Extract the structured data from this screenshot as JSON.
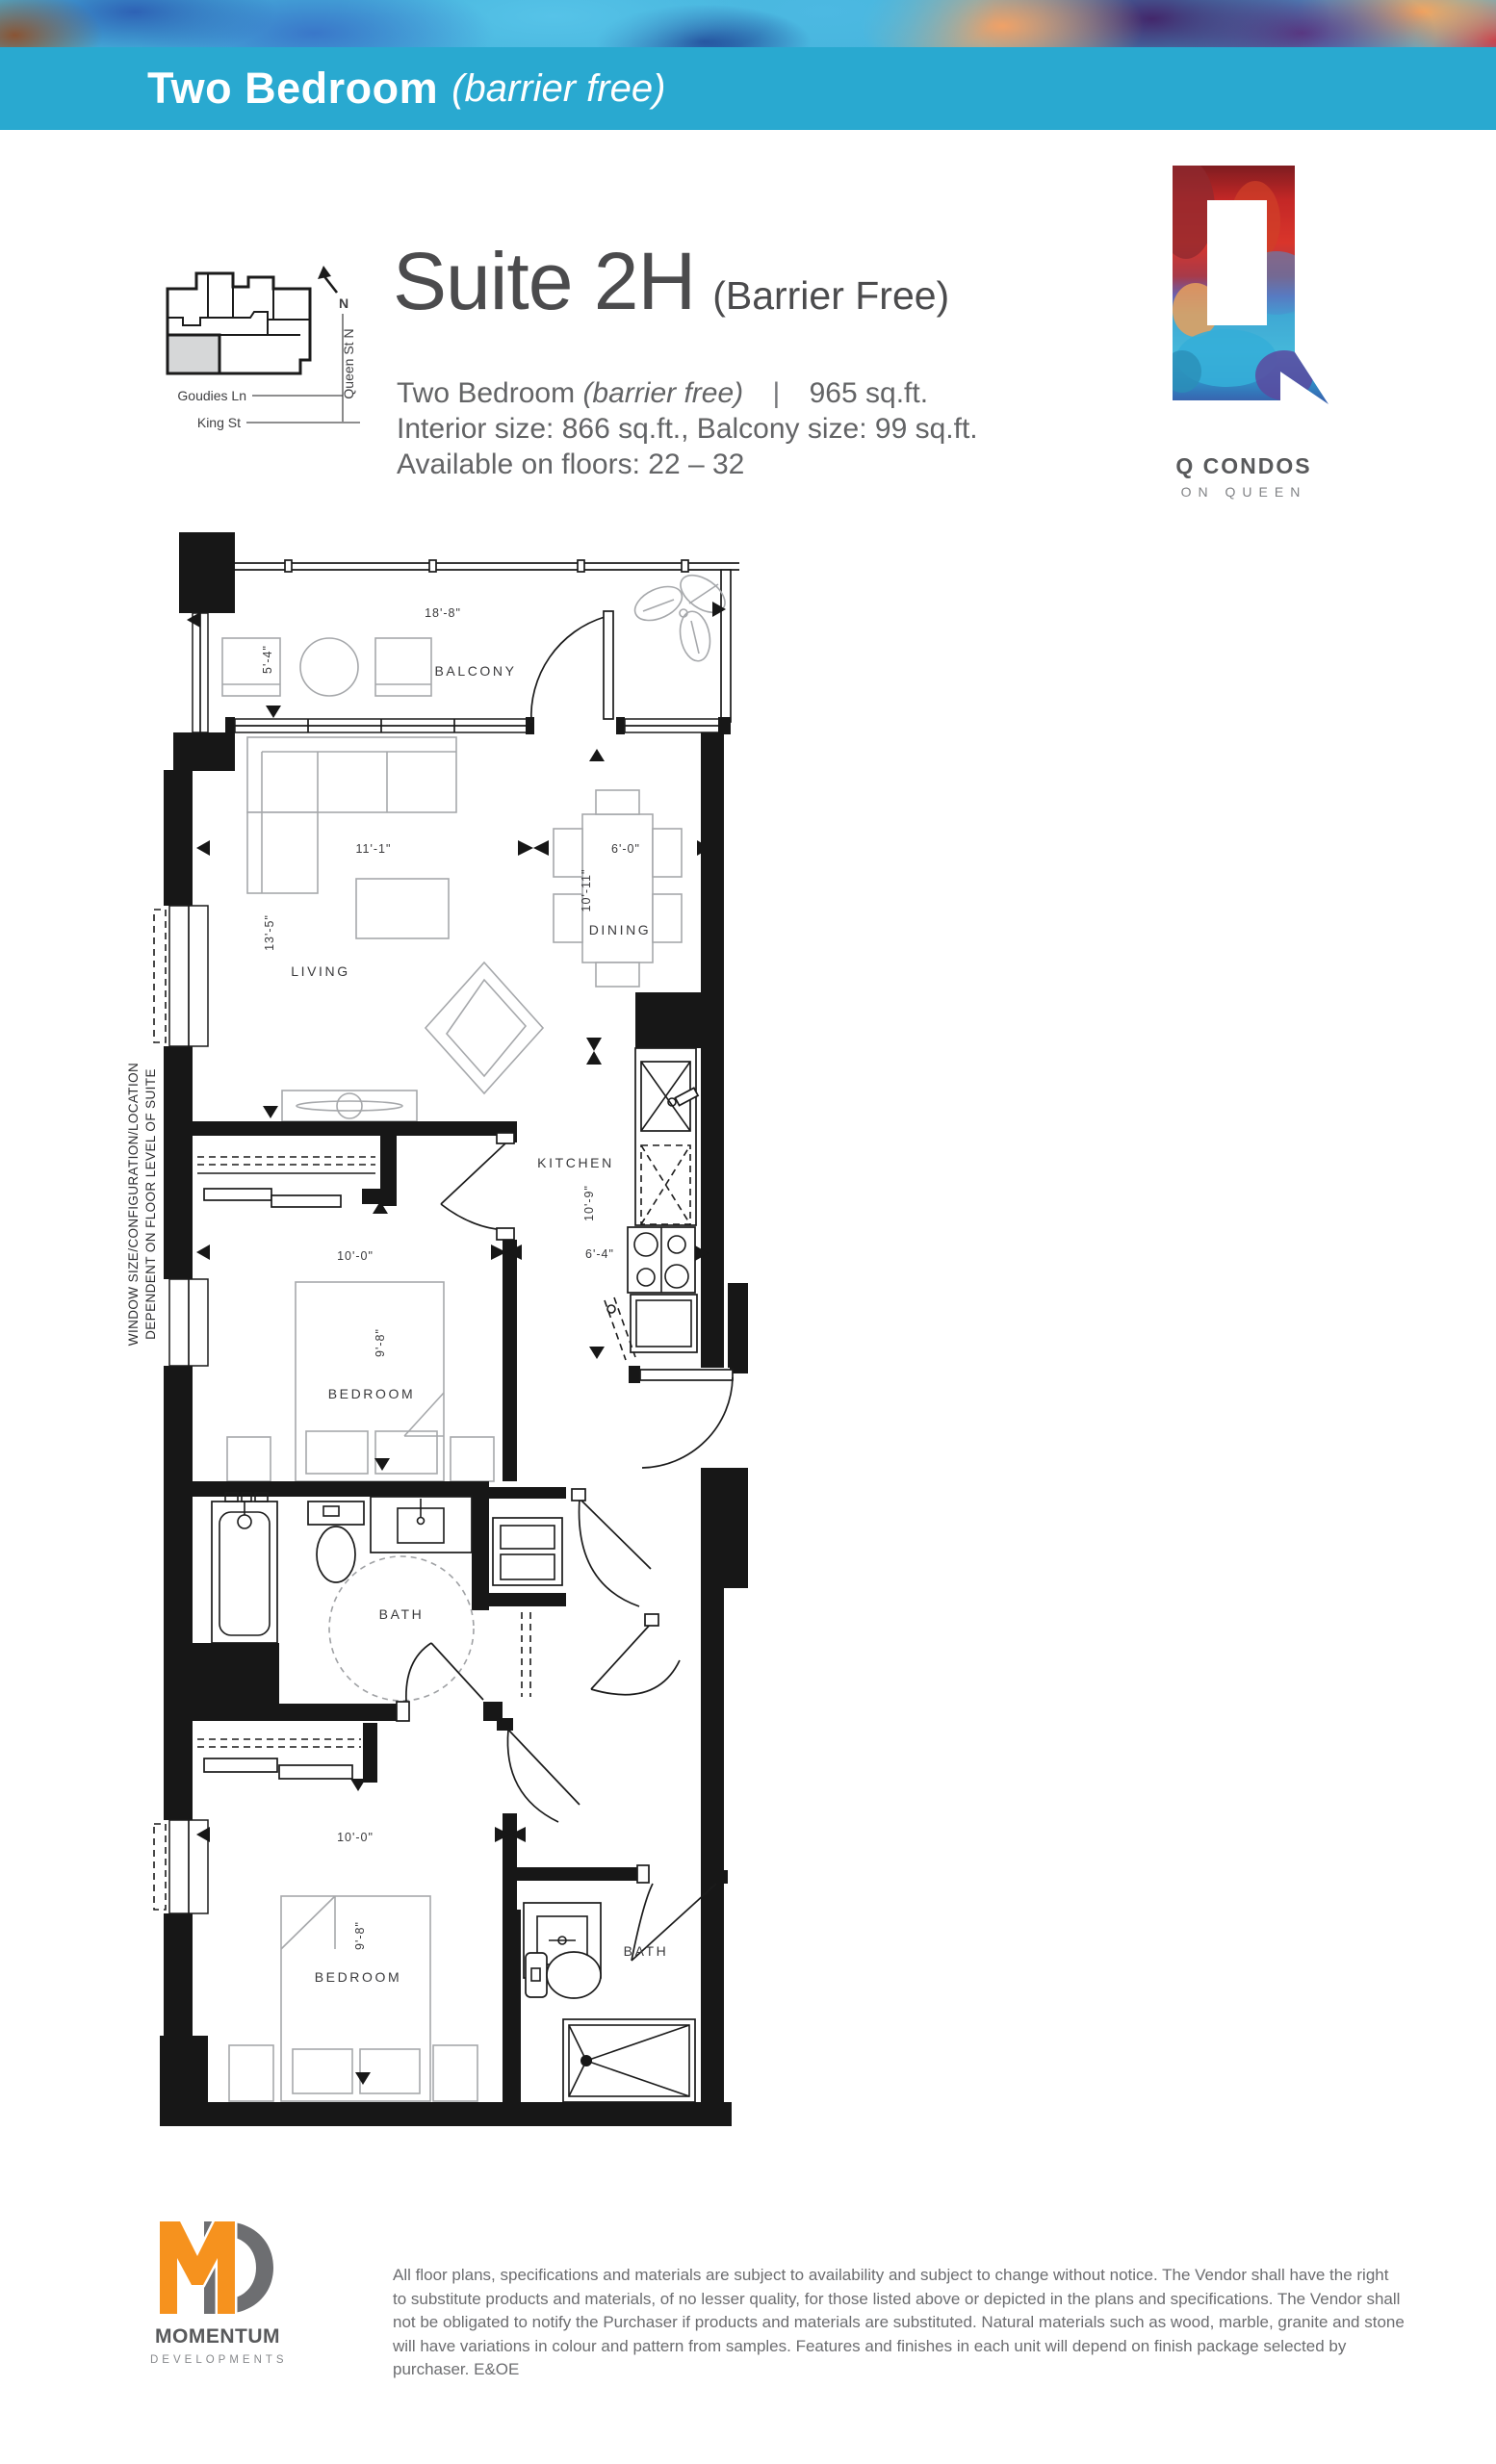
{
  "header": {
    "category": "Two Bedroom",
    "category_note": "(barrier free)"
  },
  "keymap": {
    "north": "N",
    "street_side": "Queen St N",
    "lane": "Goudies Ln",
    "street_bottom": "King St"
  },
  "title": {
    "suite": "Suite 2H",
    "qualifier": "(Barrier Free)"
  },
  "summary": {
    "type": "Two Bedroom",
    "type_note": "(barrier free)",
    "divider": "|",
    "total_area": "965 sq.ft.",
    "sizes": "Interior size: 866 sq.ft., Balcony size: 99 sq.ft.",
    "floors": "Available on floors: 22 – 32"
  },
  "brand": {
    "name": "Q CONDOS",
    "tagline": "ON QUEEN"
  },
  "plan": {
    "rooms": {
      "balcony": "BALCONY",
      "living": "LIVING",
      "dining": "DINING",
      "kitchen": "KITCHEN",
      "bedroom1": "BEDROOM",
      "bath1": "BATH",
      "bedroom2": "BEDROOM",
      "bath2": "BATH"
    },
    "dims": {
      "balcony_w": "18'-8\"",
      "balcony_d": "5'-4\"",
      "living_w": "11'-1\"",
      "living_d": "13'-5\"",
      "dining_w": "6'-0\"",
      "dining_d": "10'-11\"",
      "kitchen_d": "10'-9\"",
      "kitchen_w": "6'-4\"",
      "bedroom1_w": "10'-0\"",
      "bedroom1_d": "9'-8\"",
      "bedroom2_w": "10'-0\"",
      "bedroom2_d": "9'-8\""
    },
    "note_line1": "WINDOW SIZE/CONFIGURATION/LOCATION",
    "note_line2": "DEPENDENT ON FLOOR  LEVEL OF SUITE"
  },
  "footer": {
    "developer": "MOMENTUM",
    "developer_sub": "DEVELOPMENTS",
    "disclaimer": "All floor plans, specifications and materials are subject to availability and subject to change without notice.  The Vendor shall have the right to substitute products and materials, of no lesser quality, for those listed above or depicted in the plans and specifications. The Vendor shall not be obligated to notify the Purchaser if products and materials are substituted. Natural materials such as wood, marble, granite and stone will have variations in colour and pattern from samples. Features and finishes in each unit will depend on finish package selected by purchaser.  E&OE"
  },
  "colors": {
    "accent_blue": "#29A9D0",
    "logo_orange": "#F6921E",
    "logo_gray": "#6D6E71",
    "suite_highlight": "#D6D7D8"
  }
}
